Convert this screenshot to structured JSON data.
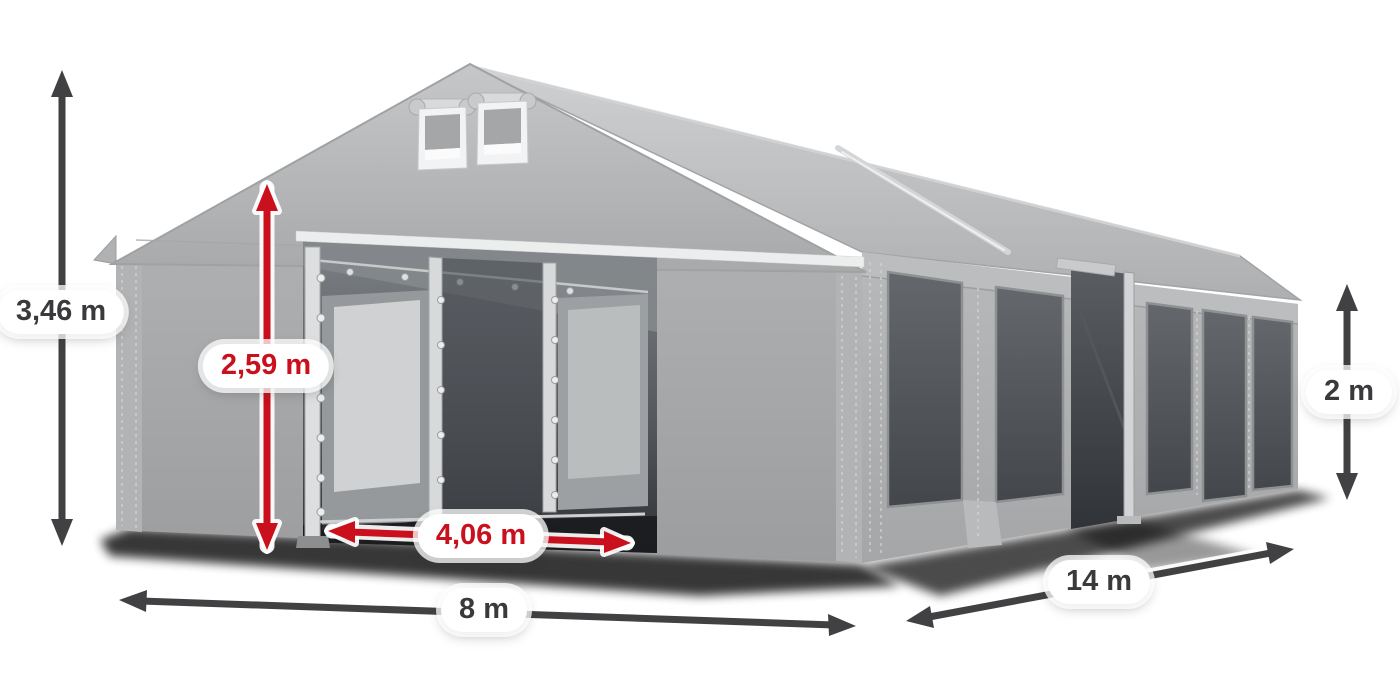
{
  "illustration": {
    "subject": "party-tent-dimension-diagram"
  },
  "dimensions": {
    "total_height": {
      "value": "3,46 m"
    },
    "entrance_height": {
      "value": "2,59 m"
    },
    "entrance_width": {
      "value": "4,06 m"
    },
    "front_width": {
      "value": "8 m"
    },
    "side_length": {
      "value": "14 m"
    },
    "side_wall_height": {
      "value": "2 m"
    }
  },
  "colors": {
    "dimension_dark": "#414143",
    "dimension_red": "#c9101c",
    "label_text_dark": "#3a3a3c",
    "label_text_red": "#c9101c",
    "label_background": "#ffffff",
    "tent_fabric_light": "#c4c5c7",
    "tent_fabric": "#aaabad",
    "window_glass": "#53575b",
    "frame_white": "#eceded"
  }
}
